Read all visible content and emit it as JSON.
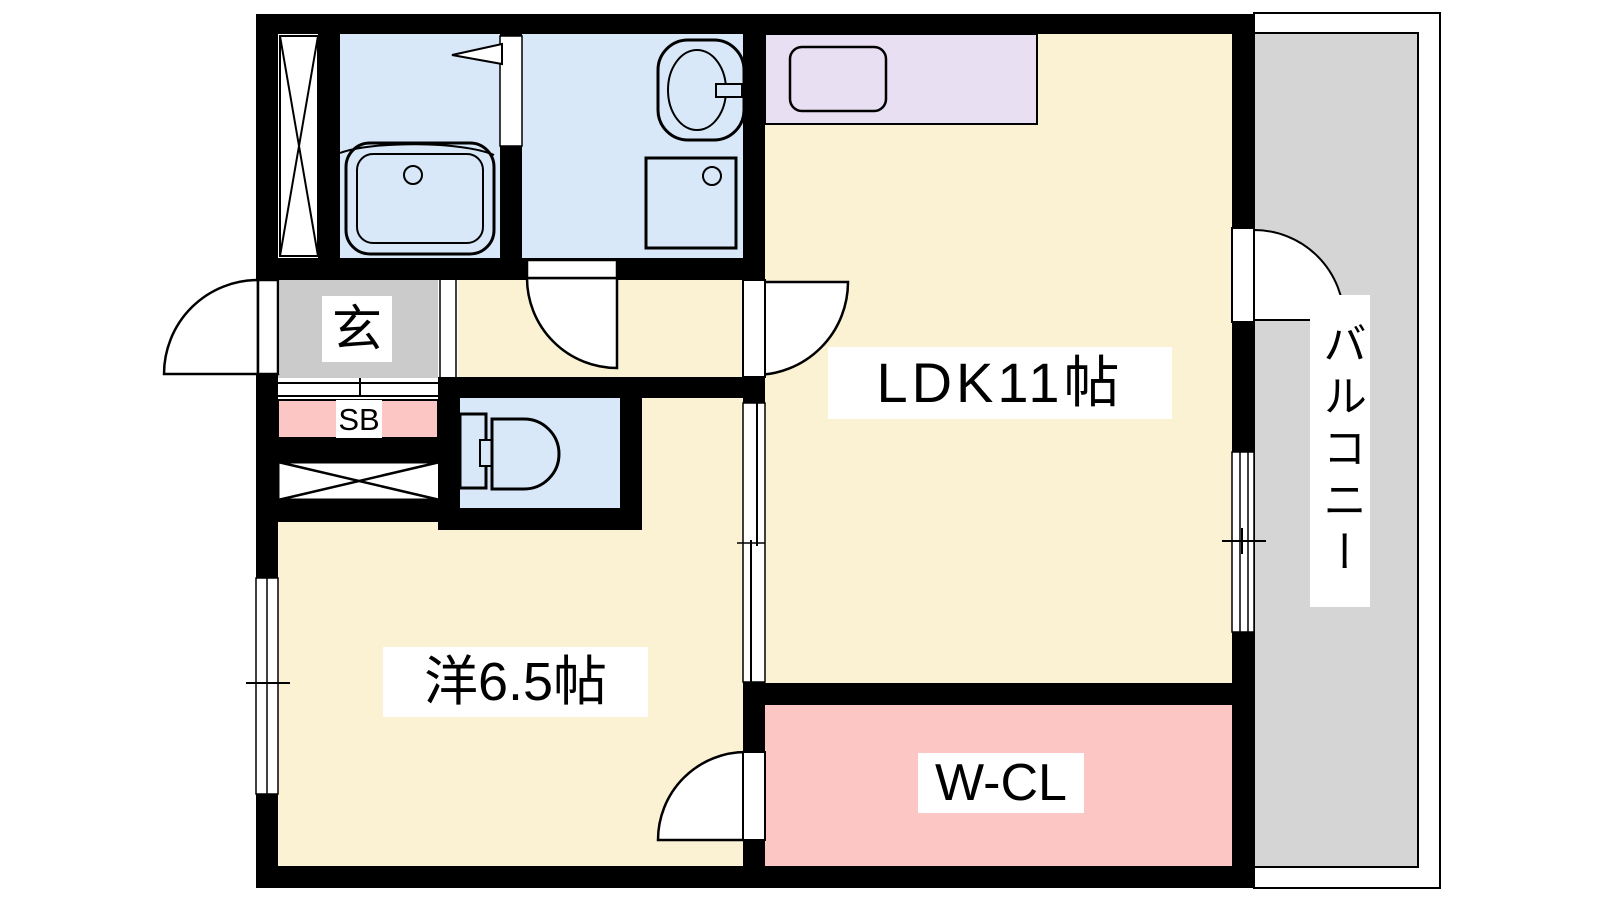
{
  "rooms": {
    "ldk": {
      "label": "LDK11帖"
    },
    "western": {
      "label": "洋6.5帖"
    },
    "wcl": {
      "label": "W-CL"
    },
    "balcony": {
      "label": "バルコニー"
    },
    "entrance": {
      "label": "玄"
    },
    "shoebox": {
      "label": "SB"
    }
  },
  "colors": {
    "cream": "#FBF1D3",
    "wet_blue": "#D8E8F8",
    "kitchen_purple": "#E8DFF3",
    "closet_pink": "#FCC6C5",
    "entrance_gray": "#CBCBCB",
    "balcony_gray": "#D5D5D5",
    "wall": "#000000",
    "white": "#FFFFFF"
  }
}
